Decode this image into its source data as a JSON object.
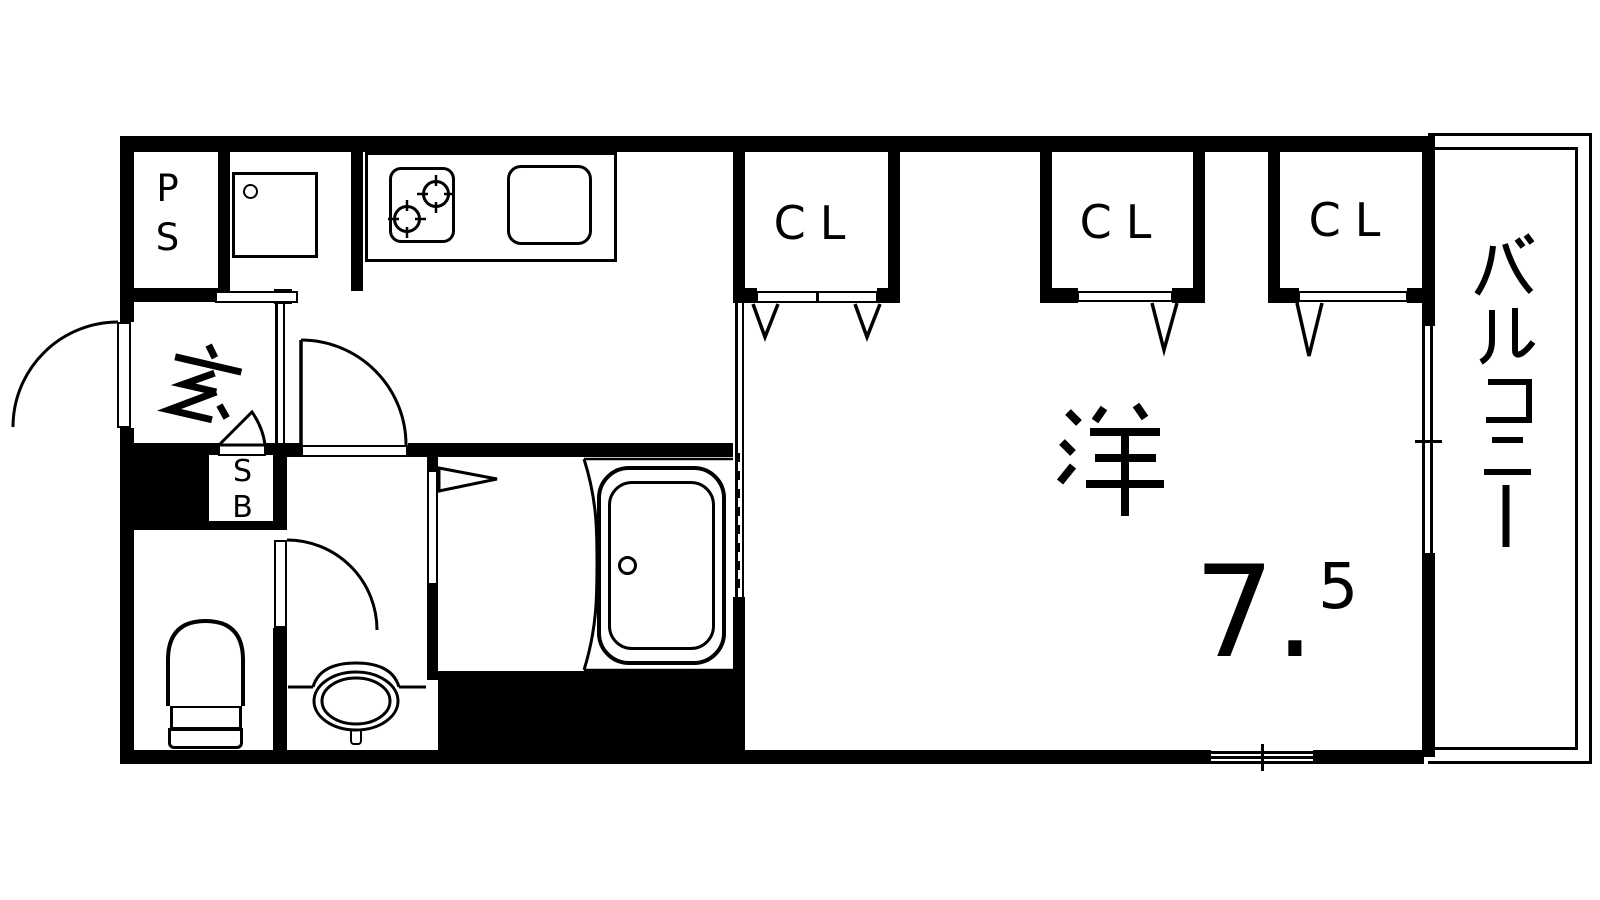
{
  "title": "apartment-floor-plan",
  "labels": {
    "pipe_space": "PS",
    "shoe_box": "SB",
    "entrance": "玄",
    "balcony": "バルコニー",
    "room_kanji": "洋",
    "room_size_main": "7.",
    "room_size_sup": "5"
  },
  "closets": [
    {
      "label": "CL"
    },
    {
      "label": "CL"
    },
    {
      "label": "CL"
    }
  ],
  "rooms": {
    "western_room": "洋 7.5",
    "entrance_hall": "玄",
    "balcony": "バルコニー",
    "pipe_space": "PS",
    "shoe_box": "SB"
  },
  "fixtures": {
    "stove": "gas-stove-two-burner",
    "kitchen_sink": "kitchen-sink",
    "washer_space": "washing-machine-space",
    "bathtub": "bathtub",
    "toilet": "toilet",
    "wash_basin": "wash-basin",
    "front_door": "entrance-door-swing",
    "closet_doors": "folding-doors"
  },
  "colors": {
    "line": "#000000",
    "background": "#ffffff"
  }
}
